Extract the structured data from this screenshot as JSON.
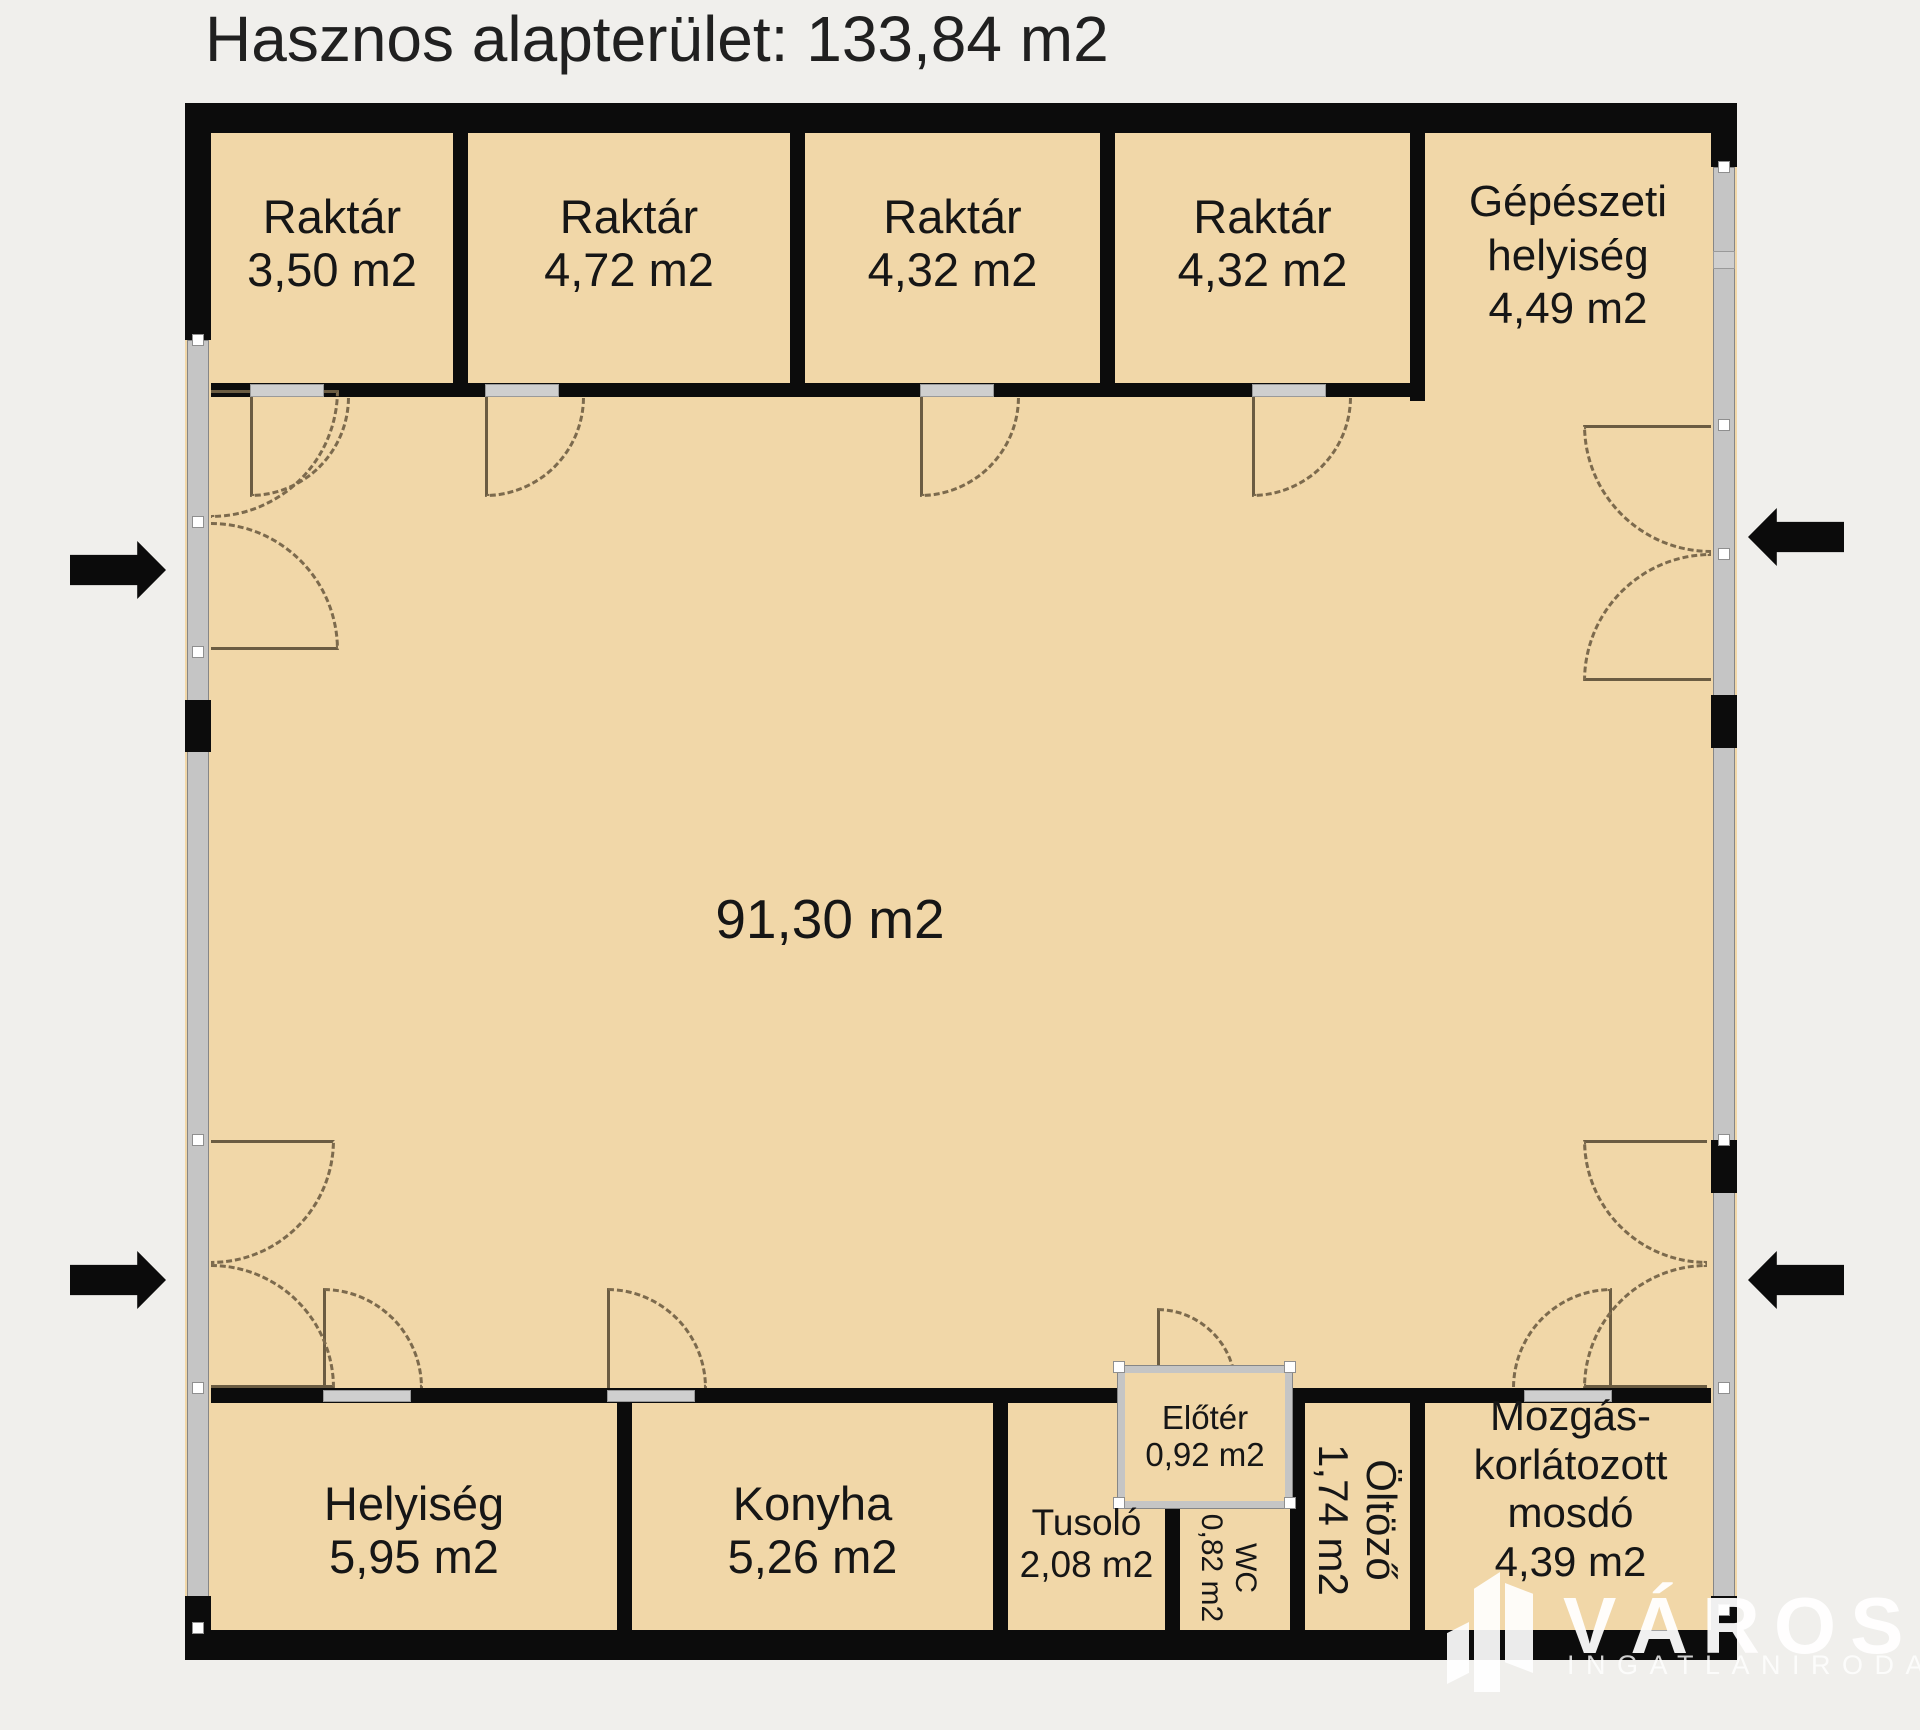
{
  "title": "Hasznos alapterület: 133,84 m2",
  "rooms": {
    "raktar1": {
      "name": "Raktár",
      "area": "3,50 m2"
    },
    "raktar2": {
      "name": "Raktár",
      "area": "4,72 m2"
    },
    "raktar3": {
      "name": "Raktár",
      "area": "4,32 m2"
    },
    "raktar4": {
      "name": "Raktár",
      "area": "4,32 m2"
    },
    "gepeszeti": {
      "name_line1": "Gépészeti",
      "name_line2": "helyiség",
      "area": "4,49 m2"
    },
    "hall": {
      "area": "91,30 m2"
    },
    "helyiseg": {
      "name": "Helyiség",
      "area": "5,95 m2"
    },
    "konyha": {
      "name": "Konyha",
      "area": "5,26 m2"
    },
    "tusolo": {
      "name": "Tusoló",
      "area": "2,08 m2"
    },
    "eloter": {
      "name": "Előtér",
      "area": "0,92 m2"
    },
    "wc": {
      "name": "WC",
      "area": "0,82 m2"
    },
    "oltozo": {
      "name": "Öltöző",
      "area": "1,74 m2"
    },
    "mosdo": {
      "name_line1": "Mozgás-",
      "name_line2": "korlátozott",
      "name_line3": "mosdó",
      "area": "4,39 m2"
    }
  },
  "watermark": {
    "brand": "VÁROSI",
    "subtitle": "INGATLANIRODA"
  },
  "colors": {
    "room_fill": "#f1d7a8",
    "wall": "#0c0c0c",
    "glass_wall": "#c5c5c5",
    "background": "#f0efec",
    "door_arc": "#7c6a4d",
    "watermark_text": "#ffffff"
  }
}
